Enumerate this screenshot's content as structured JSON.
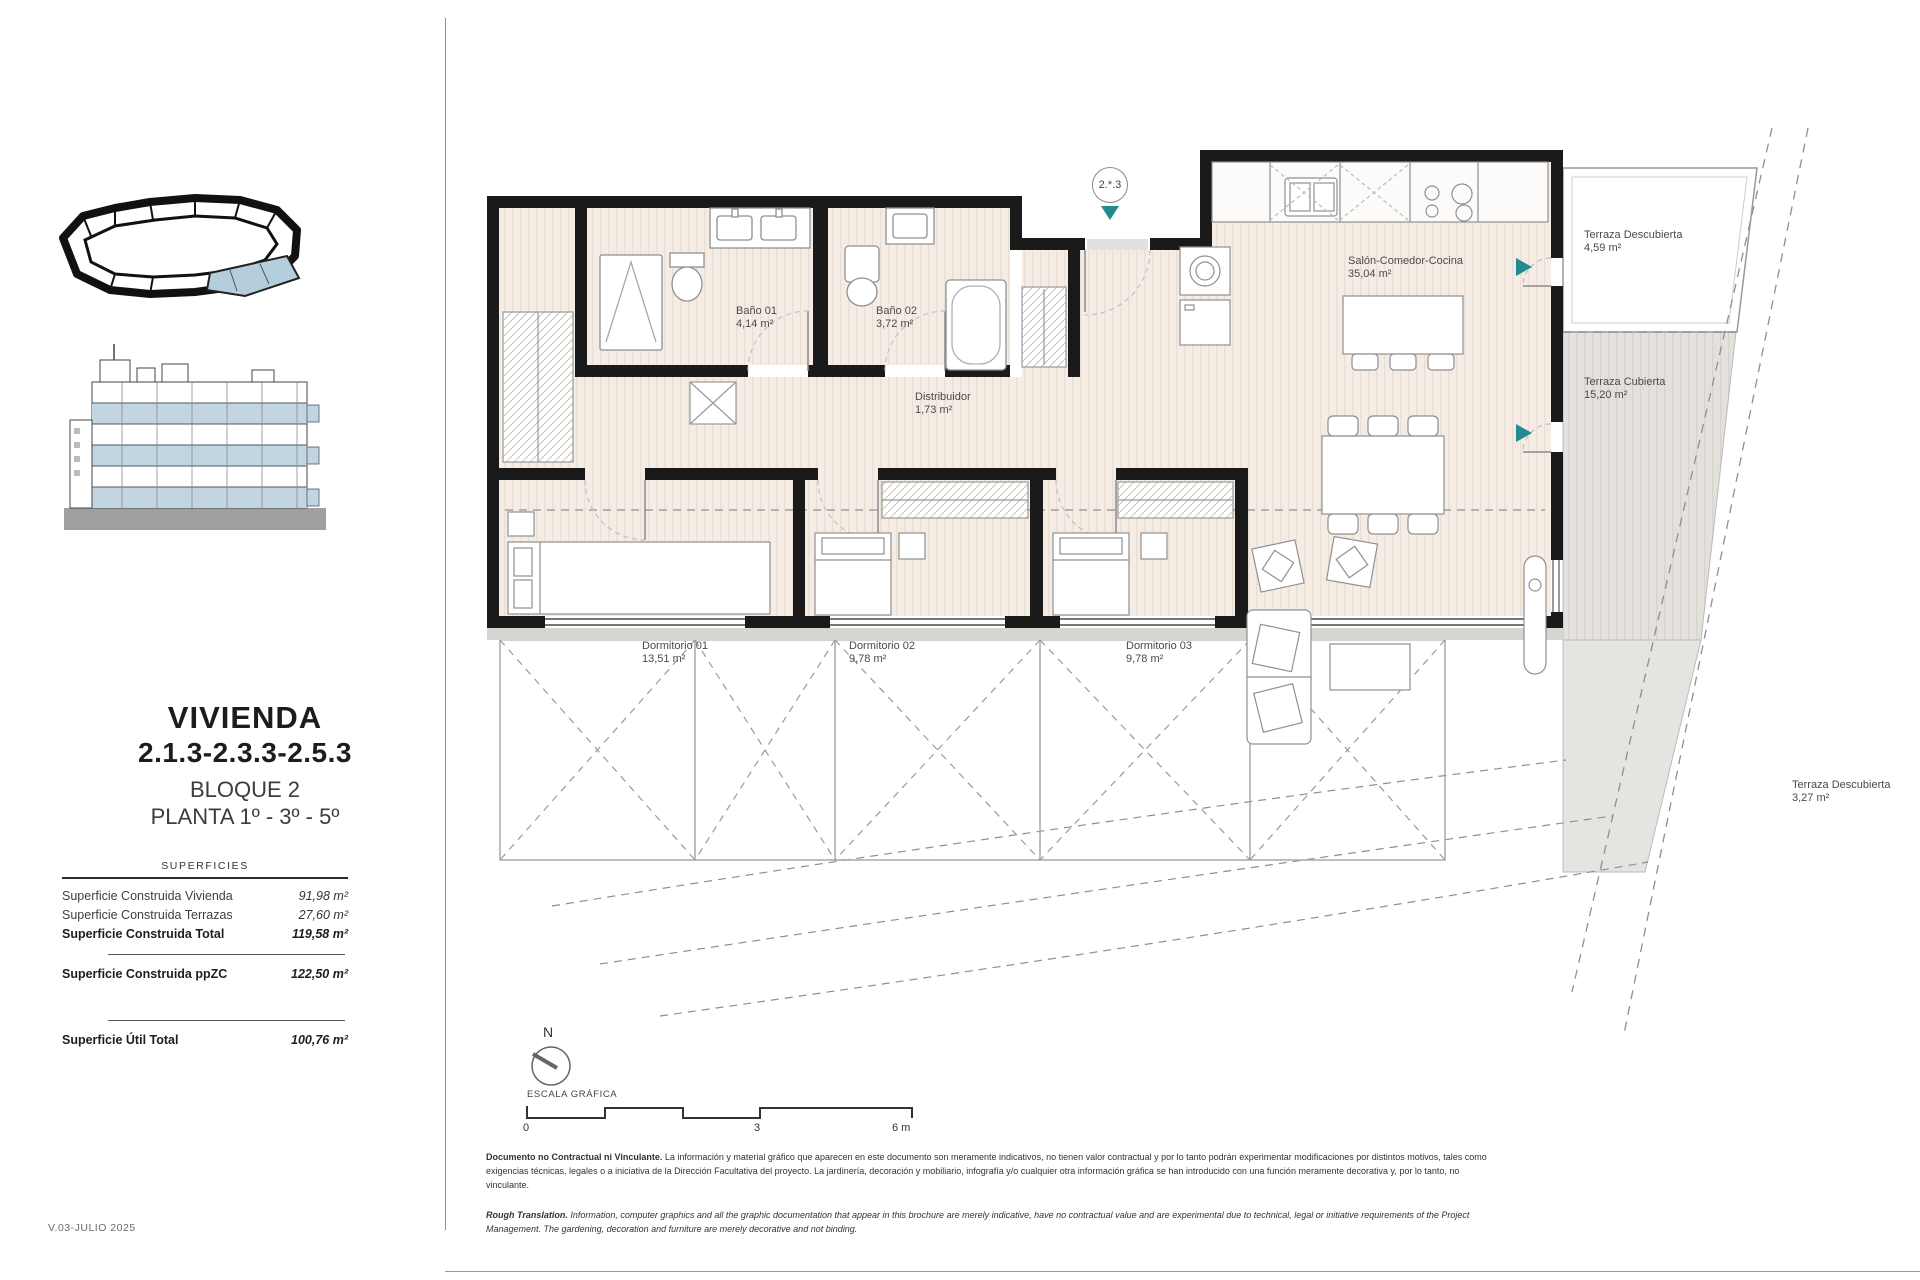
{
  "page": {
    "version_label": "V.03-JULIO 2025"
  },
  "sidebar": {
    "title_line1": "VIVIENDA",
    "title_line2": "2.1.3-2.3.3-2.5.3",
    "subtitle_line1": "BLOQUE 2",
    "subtitle_line2": "PLANTA 1º - 3º - 5º",
    "table": {
      "heading": "SUPERFICIES",
      "rows": [
        {
          "label": "Superficie Construida Vivienda",
          "value": "91,98 m²"
        },
        {
          "label": "Superficie Construida Terrazas",
          "value": "27,60 m²"
        },
        {
          "label": "Superficie Construida Total",
          "value": "119,58 m²"
        },
        {
          "label": "Superficie Construida ppZC",
          "value": "122,50 m²"
        },
        {
          "label": "Superficie Útil Total",
          "value": "100,76 m²"
        }
      ]
    }
  },
  "plan": {
    "unit_badge": "2.*.3",
    "rooms": [
      {
        "name": "Baño 01",
        "area": "4,14 m²"
      },
      {
        "name": "Baño 02",
        "area": "3,72 m²"
      },
      {
        "name": "Distribuidor",
        "area": "1,73 m²"
      },
      {
        "name": "Salón-Comedor-Cocina",
        "area": "35,04 m²"
      },
      {
        "name": "Dormitorio 01",
        "area": "13,51 m²"
      },
      {
        "name": "Dormitorio 02",
        "area": "9,78 m²"
      },
      {
        "name": "Dormitorio 03",
        "area": "9,78 m²"
      },
      {
        "name": "Terraza Descubierta",
        "area": "4,59 m²"
      },
      {
        "name": "Terraza Cubierta",
        "area": "15,20 m²"
      },
      {
        "name": "Terraza Descubierta",
        "area": "3,27 m²"
      }
    ],
    "north_label": "N",
    "scale": {
      "label": "ESCALA GRÁFICA",
      "tick0": "0",
      "tick3": "3",
      "tick6": "6 m"
    }
  },
  "footer": {
    "disclaimer_es_lead": "Documento no Contractual ni Vinculante.",
    "disclaimer_es_body": " La información y material gráfico que aparecen en este documento son meramente indicativos, no tienen valor contractual y por lo tanto podrán experimentar modificaciones por distintos motivos, tales como exigencias técnicas, legales o a iniciativa de la Dirección Facultativa del proyecto. La jardinería, decoración y mobiliario, infografía y/o cualquier otra información gráfica se han introducido con una función meramente decorativa y, por lo tanto, no vinculante.",
    "disclaimer_en_lead": "Rough Translation.",
    "disclaimer_en_body": " Information, computer graphics and all the graphic documentation that appear in this brochure are merely indicative, have no contractual value and are experimental due to technical, legal or initiative requirements of the Project Management. The gardening, decoration and furniture are merely decorative and not binding."
  },
  "colors": {
    "wall": "#1a1a1a",
    "accent_teal": "#238a90",
    "highlight_blue": "#b5cedd",
    "floor_beige": "#f5ede5",
    "terrace_gray": "#e4e1dd"
  }
}
